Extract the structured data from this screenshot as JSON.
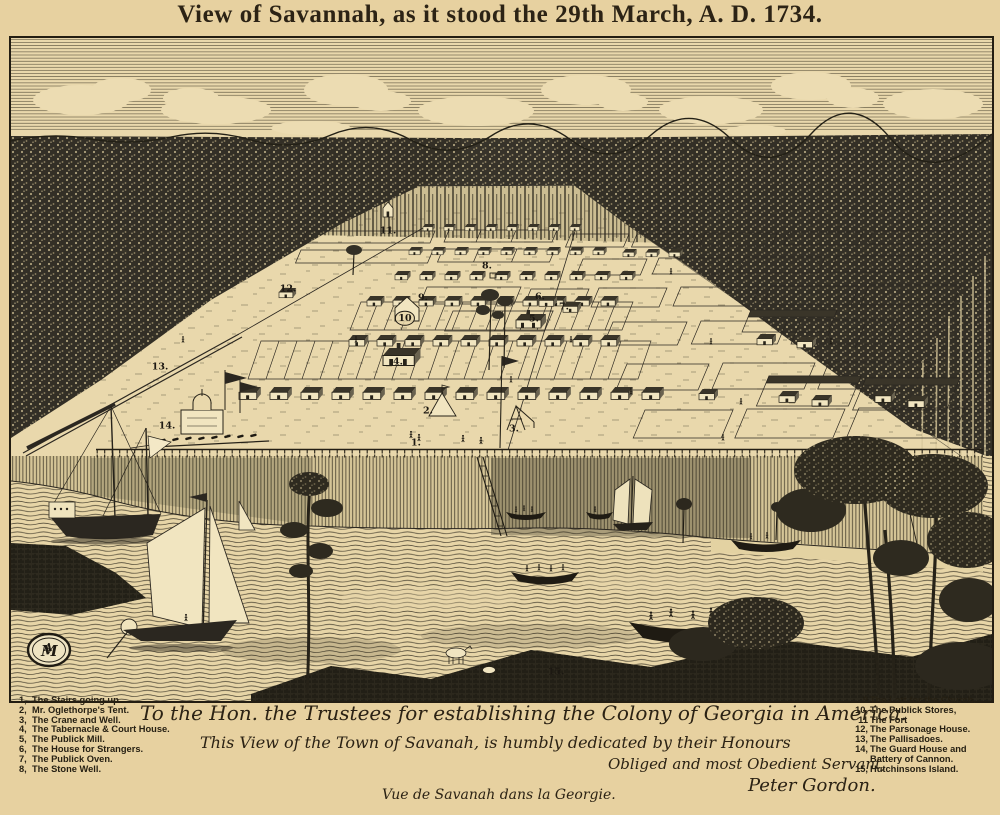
{
  "header": {
    "title": "View of Savannah, as it stood the 29th March, A. D. 1734."
  },
  "map": {
    "ink_color": "#2a251b",
    "paper_color": "#e9d8ac",
    "markers": [
      {
        "label": "1.",
        "x": 416,
        "y": 443
      },
      {
        "label": "2.",
        "x": 428,
        "y": 411
      },
      {
        "label": "3.",
        "x": 514,
        "y": 429
      },
      {
        "label": "4.",
        "x": 398,
        "y": 362
      },
      {
        "label": "5.",
        "x": 534,
        "y": 319
      },
      {
        "label": "6.",
        "x": 540,
        "y": 297
      },
      {
        "label": "7.",
        "x": 564,
        "y": 307
      },
      {
        "label": "8.",
        "x": 487,
        "y": 266
      },
      {
        "label": "9.",
        "x": 423,
        "y": 298
      },
      {
        "label": "10",
        "x": 405,
        "y": 318,
        "circled": true
      },
      {
        "label": "11.",
        "x": 388,
        "y": 231
      },
      {
        "label": "12.",
        "x": 288,
        "y": 289
      },
      {
        "label": "13.",
        "x": 160,
        "y": 367
      },
      {
        "label": "14.",
        "x": 167,
        "y": 426
      },
      {
        "label": "15.",
        "x": 556,
        "y": 672
      }
    ]
  },
  "legend_left": {
    "items": [
      {
        "num": "1,",
        "text": "The Stairs going up."
      },
      {
        "num": "2,",
        "text": "Mr. Oglethorpe's Tent."
      },
      {
        "num": "3,",
        "text": "The Crane and Well."
      },
      {
        "num": "4,",
        "text": "The Tabernacle & Court House."
      },
      {
        "num": "5,",
        "text": "The Publick Mill."
      },
      {
        "num": "6,",
        "text": "The House for Strangers."
      },
      {
        "num": "7,",
        "text": "The Publick Oven."
      },
      {
        "num": "8,",
        "text": "The Stone Well."
      }
    ]
  },
  "legend_right": {
    "items": [
      {
        "num": "9",
        "text": "The Lott for the Church."
      },
      {
        "num": "10,",
        "text": "The Publick Stores,"
      },
      {
        "num": "11",
        "text": "The Fort"
      },
      {
        "num": "12,",
        "text": "The Parsonage House."
      },
      {
        "num": "13,",
        "text": "The Pallisadoes."
      },
      {
        "num": "14,",
        "text": "The Guard House and Battery of Cannon."
      },
      {
        "num": "15,",
        "text": "Hutchinsons Island."
      }
    ]
  },
  "dedication": {
    "line1": "To the Hon. the Trustees for establishing the Colony of Georgia in America.",
    "line2": "This View of the Town of Savanah, is humbly dedicated by their Honours",
    "line3": "Obliged and most Obedient Servant,",
    "signature": "Peter Gordon.",
    "caption_fr": "Vue de Savanah dans la Georgie."
  }
}
